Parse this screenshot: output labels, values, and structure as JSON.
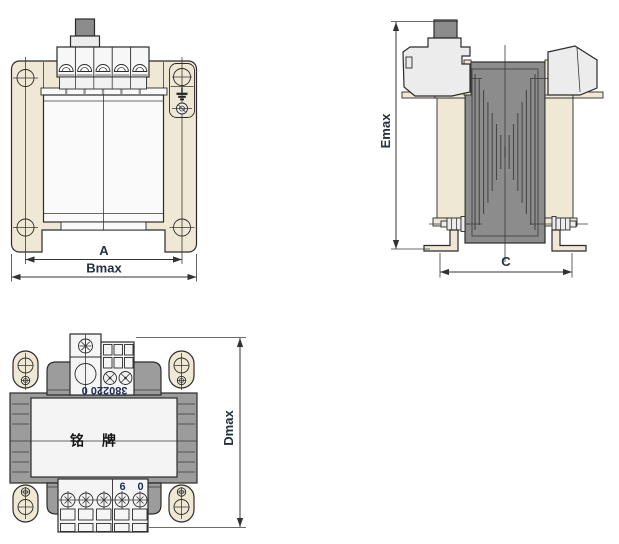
{
  "front_view": {
    "dim_a": "A",
    "dim_bmax": "Bmax"
  },
  "side_view": {
    "dim_emax": "Emax",
    "dim_c": "C"
  },
  "top_view": {
    "dim_dmax": "Dmax",
    "nameplate_text": "铭 牌",
    "primary_terminal_marking": "380220 0",
    "secondary_terminal_labels": {
      "left": "6",
      "right": "0"
    }
  },
  "colors": {
    "cream": "#efe8d4",
    "core_gray": "#8c8c8c",
    "body_gray": "#9c9c9c",
    "light_gray": "#ececec",
    "coil_white": "#fafafa",
    "nameplate": "#f4f4f4",
    "line": "#2b2b2b",
    "dim_text": "#25303e",
    "marking_blue": "#1d2b5e"
  }
}
